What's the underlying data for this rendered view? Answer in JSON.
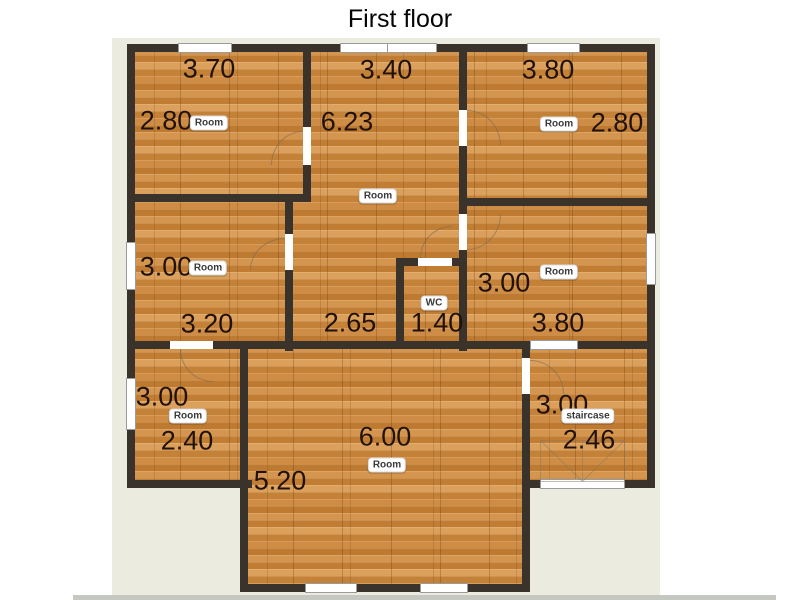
{
  "title": "First floor",
  "colors": {
    "wall": "#3a332b",
    "floor_wood": "#c98440",
    "panel_background": "#ecebe0",
    "page_background": "#ffffff",
    "dimension_text": "#20110a"
  },
  "rooms": [
    {
      "id": "top-left",
      "badge": "Room",
      "dim_top": "3.70",
      "dim_side": "2.80"
    },
    {
      "id": "hall-center",
      "badge": "Room",
      "dim_top": "3.40",
      "dim_side": "6.23",
      "dim_bottom": "2.65"
    },
    {
      "id": "top-right",
      "badge": "Room",
      "dim_top": "3.80",
      "dim_side": "2.80"
    },
    {
      "id": "middle-left",
      "badge": "Room",
      "dim_side": "3.00",
      "dim_bottom": "3.20"
    },
    {
      "id": "wc",
      "badge": "WC",
      "dim_bottom": "1.40"
    },
    {
      "id": "middle-right",
      "badge": "Room",
      "dim_side": "3.00",
      "dim_bottom": "3.80"
    },
    {
      "id": "bottom-left",
      "badge": "Room",
      "dim_side": "3.00",
      "dim_bottom": "2.40"
    },
    {
      "id": "living",
      "badge": "Room",
      "dim_top": "6.00",
      "dim_side": "5.20"
    },
    {
      "id": "staircase",
      "badge": "staircase",
      "dim_side": "3.00",
      "dim_bottom": "2.46"
    }
  ]
}
